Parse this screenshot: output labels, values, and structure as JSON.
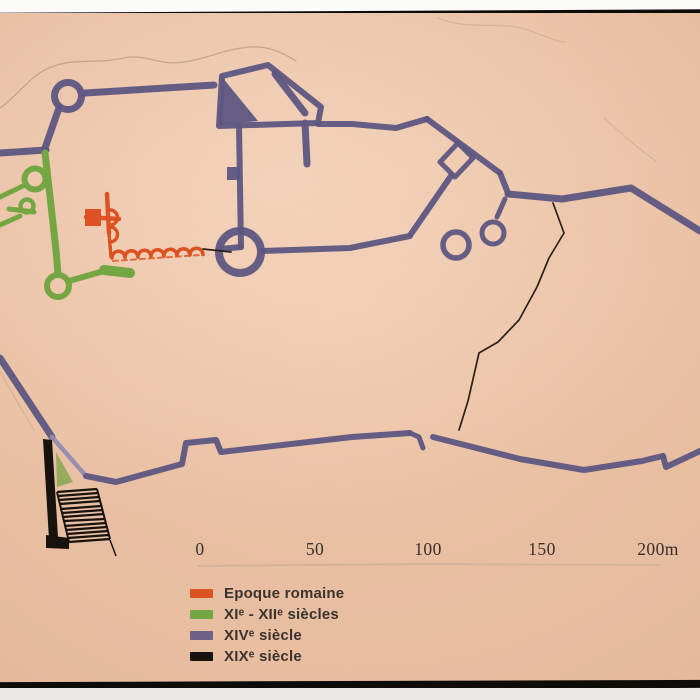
{
  "colors": {
    "roman": "#dc5222",
    "xi_xii": "#74a743",
    "xi_xii_fill": "#8ea757",
    "xiv": "#5d5681",
    "xiv_light": "#938bb0",
    "xiv_swatch": "#6e6287",
    "xix": "#17120e",
    "thin_line": "#2c211a",
    "contour": "#b2977c",
    "ink": "#3b332e",
    "scale_ink": "#39302a",
    "frame": "#0e0c09",
    "panel": "#e6bb9e"
  },
  "legend": {
    "items": [
      {
        "label": "Epoque romaine"
      },
      {
        "label": "XIᵉ - XIIᵉ siècles"
      },
      {
        "label": "XIVᵉ siècle"
      },
      {
        "label": "XIXᵉ siècle"
      }
    ]
  },
  "scale_bar": {
    "labels": [
      "0",
      "50",
      "100",
      "150",
      "200m"
    ]
  }
}
